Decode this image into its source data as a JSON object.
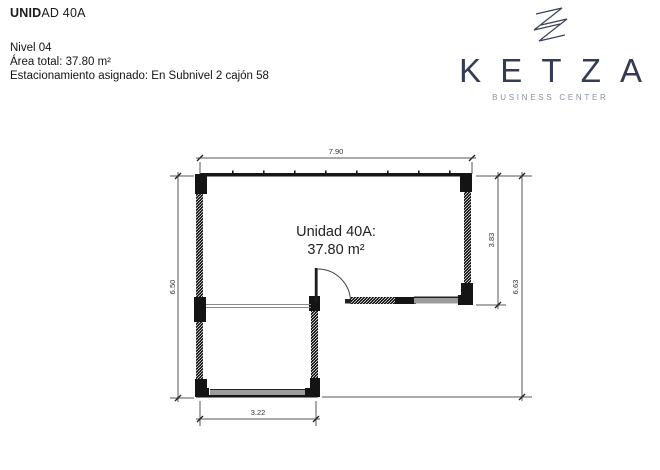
{
  "header": {
    "title_bold": "UNID",
    "title_rest": "AD 40A",
    "line1": "Nivel 04",
    "line2": "Área total: 37.80 m²",
    "line3": "Estacionamiento asignado: En Subnivel 2 cajón 58"
  },
  "logo": {
    "wordmark": "KETZA",
    "tagline": "BUSINESS CENTER",
    "brand_color": "#343b55",
    "tagline_color": "#8b909e",
    "icon": "ketza-zigzag-mark"
  },
  "floorplan": {
    "room_label_line1": "Unidad 40A:",
    "room_label_line2": "37.80 m²",
    "dim_top": "7.90",
    "dim_left": "6.50",
    "dim_right_inner": "3.83",
    "dim_right_outer": "6.63",
    "dim_bottom": "3.22",
    "wall_color": "#141414",
    "window_color": "#9c9c9c",
    "dim_line_color": "#555555"
  }
}
